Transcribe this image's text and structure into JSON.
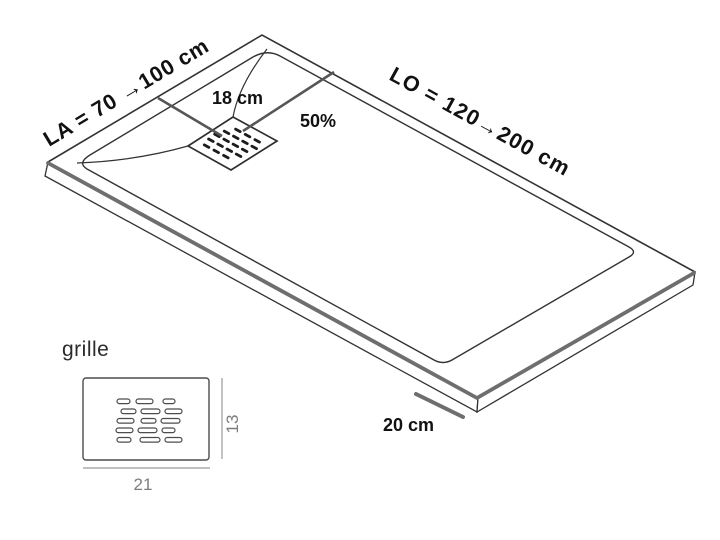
{
  "tray": {
    "width_label": "LA = 70 →100 cm",
    "length_label": "LO = 120→200 cm",
    "drain_distance_label": "18 cm",
    "slope_label": "50%",
    "edge_dimension_label": "20 cm"
  },
  "grille": {
    "title": "grille",
    "width_label": "21",
    "height_label": "13"
  },
  "colors": {
    "outline": "#333333",
    "thick_edge": "#6e6e6e",
    "measure_line": "#565656",
    "dim_line": "#9a9a9a",
    "dim_text": "#7d7d7d",
    "slot_fill": "#1c1c1c",
    "background": "#ffffff"
  }
}
